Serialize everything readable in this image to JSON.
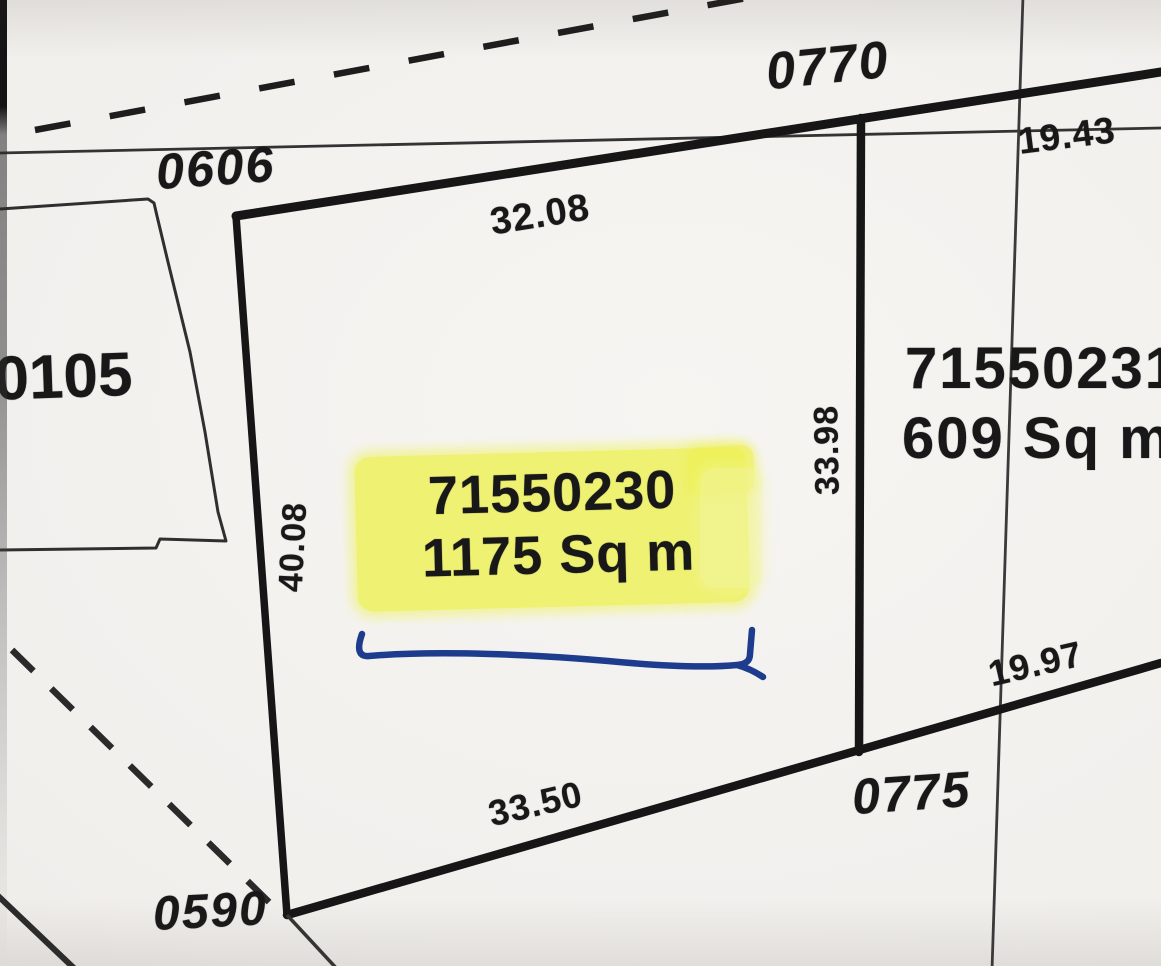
{
  "colors": {
    "paper": "#f1efec",
    "ink": "#1c1c1c",
    "highlight_yellow": "#eef153",
    "pen_blue": "#1e3c8e"
  },
  "roads": {
    "top_left": "0606",
    "top": "0770",
    "bottom": "0775",
    "bottom_left": "0590"
  },
  "main_parcel": {
    "id": "71550230",
    "area": "1175 Sq m",
    "dim_top": "32.08",
    "dim_left": "40.08",
    "dim_right": "33.98",
    "dim_bottom": "33.50"
  },
  "east_parcel": {
    "id": "71550231",
    "area": "609 Sq m",
    "dim_top": "19.43",
    "dim_bottom": "19.97"
  },
  "west_parcel": {
    "id": "50105"
  }
}
